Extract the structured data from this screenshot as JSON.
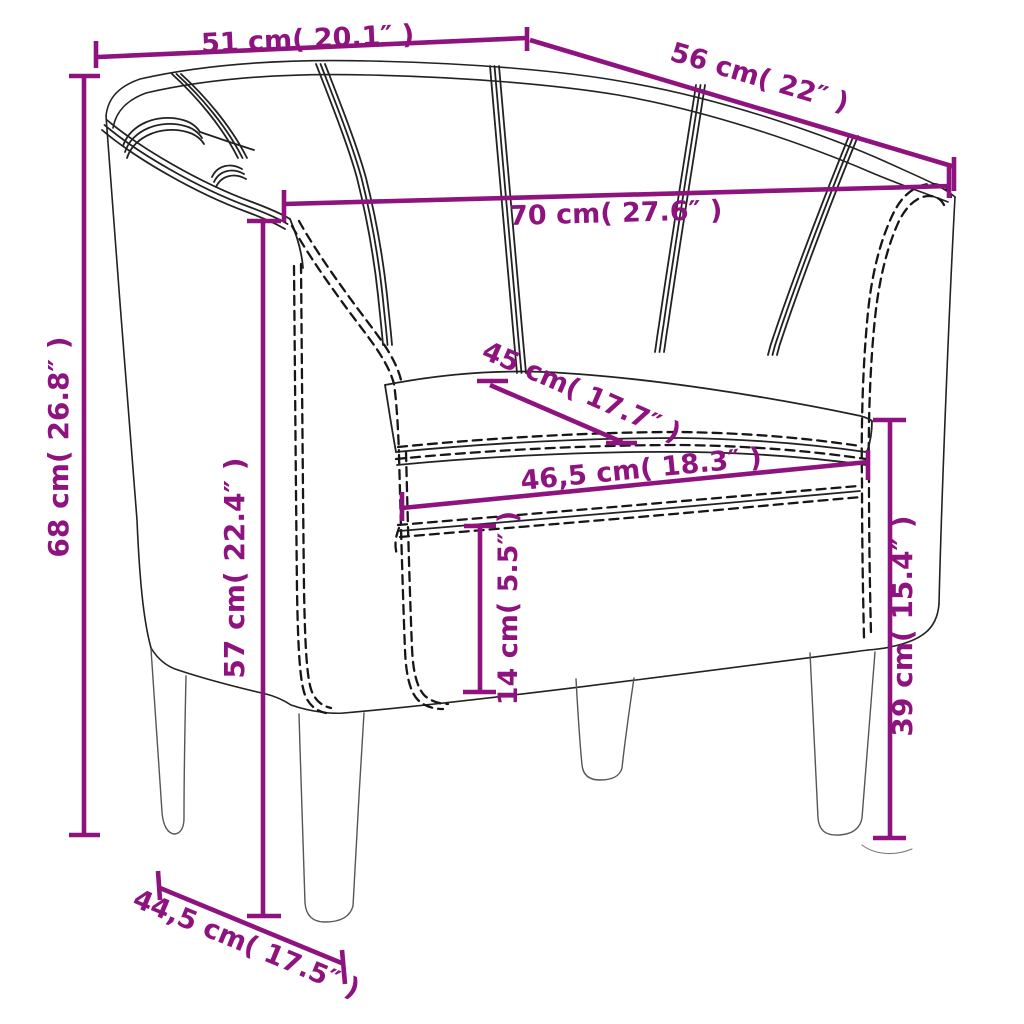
{
  "figure": {
    "type": "product-dimension-diagram",
    "subject": "tub chair line drawing",
    "accent_color": "#8E137F",
    "line_color": "#222222",
    "background": "#ffffff"
  },
  "dimensions": [
    {
      "id": "top-width",
      "cm": "51",
      "inch": "20.1",
      "label": "51 cm( 20.1″ )"
    },
    {
      "id": "top-depth",
      "cm": "56",
      "inch": "22",
      "label": "56 cm( 22″ )"
    },
    {
      "id": "inner-width",
      "cm": "70",
      "inch": "27.6",
      "label": "70 cm( 27.6″ )"
    },
    {
      "id": "total-height",
      "cm": "68",
      "inch": "26.8",
      "label": "68 cm( 26.8″ )"
    },
    {
      "id": "seat-depth",
      "cm": "45",
      "inch": "17.7",
      "label": "45 cm( 17.7″ )"
    },
    {
      "id": "seat-width",
      "cm": "46,5",
      "inch": "18.3",
      "label": "46,5 cm( 18.3″ )"
    },
    {
      "id": "back-height",
      "cm": "57",
      "inch": "22.4",
      "label": "57 cm( 22.4″ )"
    },
    {
      "id": "cushion-height",
      "cm": "14",
      "inch": "5.5",
      "label": "14 cm( 5.5″ )"
    },
    {
      "id": "seat-height",
      "cm": "39",
      "inch": "15.4",
      "label": "39 cm( 15.4″ )"
    },
    {
      "id": "base-depth",
      "cm": "44,5",
      "inch": "17.5",
      "label": "44,5 cm( 17.5″ )"
    }
  ]
}
